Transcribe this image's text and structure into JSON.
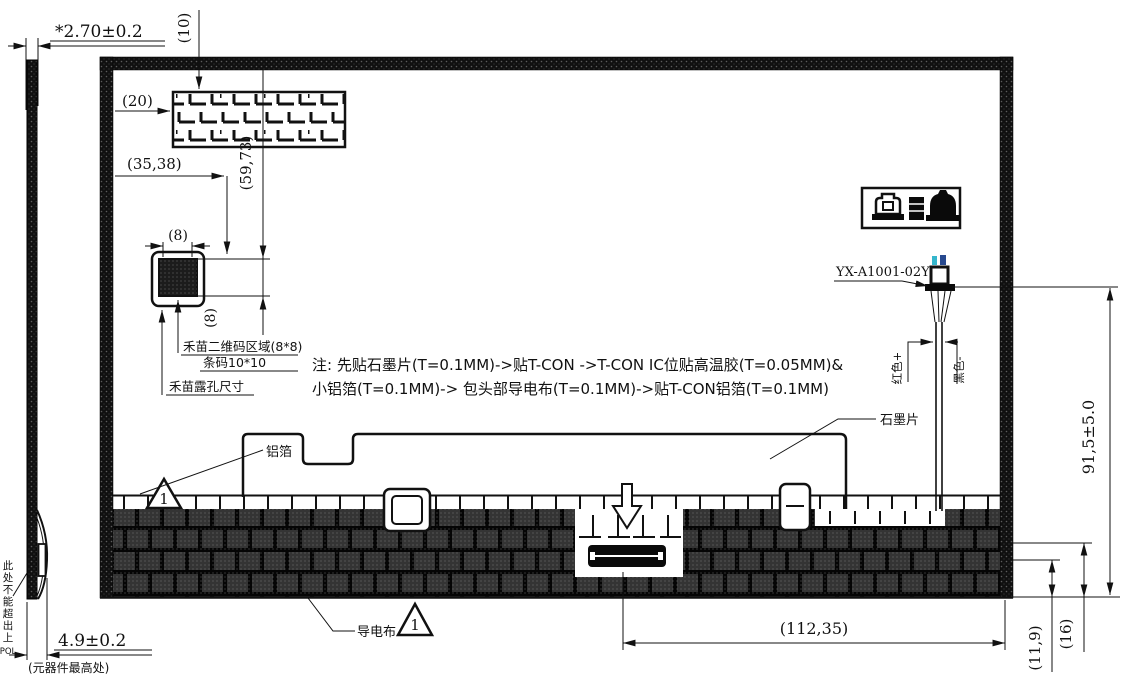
{
  "colors": {
    "line": "#111111",
    "wire_mark_cyan": "#35b6cc",
    "wire_mark_blue": "#27498f"
  },
  "side_view": {
    "thickness_dim": "*2.70±0.2",
    "height_dim": "4.9±0.2",
    "height_note": "(元器件最高处)",
    "edge_note_chars": "此处不能超出上",
    "edge_note_suffix": "POL"
  },
  "top_area": {
    "dim_10": "(10)",
    "dim_20": "(20)",
    "dim_35_38": "(35,38)",
    "dim_59_73": "(59,73)"
  },
  "qr_detail": {
    "dim_width": "(8)",
    "dim_height": "(8)",
    "label_area": "禾苗二维码区域(8*8)",
    "label_barcode": "条码10*10",
    "label_hole": "禾苗露孔尺寸"
  },
  "notes": {
    "line1": "注: 先贴石墨片(T=0.1MM)->贴T-CON ->T-CON IC位贴高温胶(T=0.05MM)&",
    "line2": "小铝箔(T=0.1MM)-> 包头部导电布(T=0.1MM)->贴T-CON铝箔(T=0.1MM)"
  },
  "labels": {
    "foil": "铝箔",
    "graphite": "石墨片",
    "cloth": "导电布",
    "marker": "1"
  },
  "cable": {
    "part_no": "YX-A1001-02Y",
    "wire_red": "红色+",
    "wire_black": "黑色-",
    "length_dim": "91,5±5.0"
  },
  "bottom_dims": {
    "width": "(112,35)",
    "h1": "(11,9)",
    "h2": "(16)"
  }
}
